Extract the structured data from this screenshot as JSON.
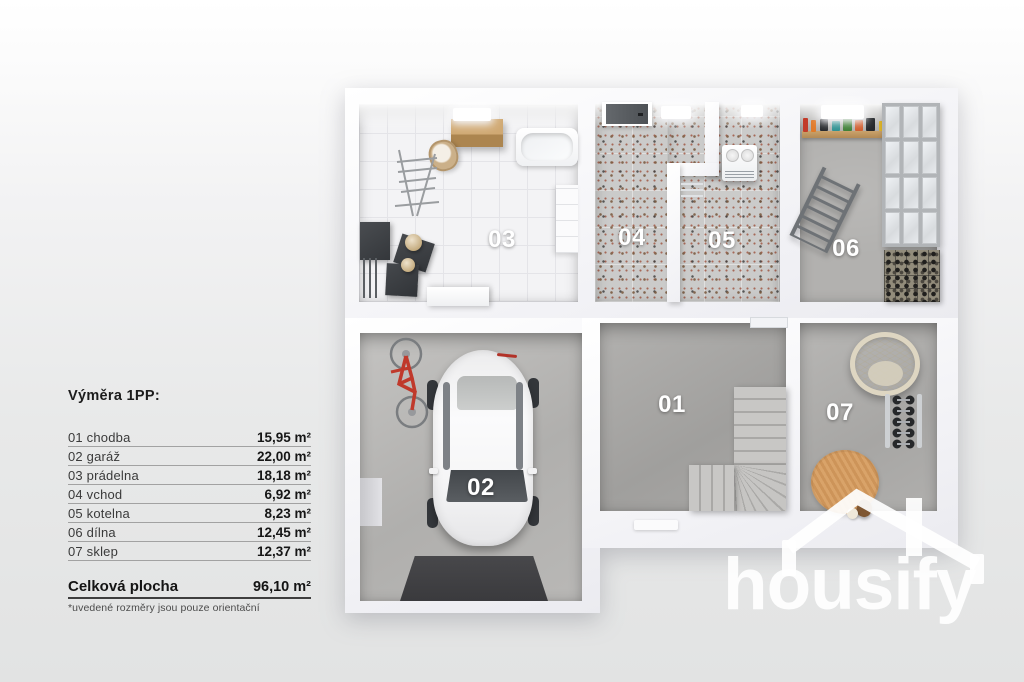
{
  "legend": {
    "title": "Výměra 1PP:",
    "rooms": [
      {
        "name": "01 chodba",
        "area": "15,95 m²"
      },
      {
        "name": "02 garáž",
        "area": "22,00 m²"
      },
      {
        "name": "03 prádelna",
        "area": "18,18 m²"
      },
      {
        "name": "04 vchod",
        "area": "6,92 m²"
      },
      {
        "name": "05 kotelna",
        "area": "8,23 m²"
      },
      {
        "name": "06 dílna",
        "area": "12,45 m²"
      },
      {
        "name": "07 sklep",
        "area": "12,37 m²"
      }
    ],
    "total_label": "Celková plocha",
    "total_area": "96,10 m²",
    "footnote": "*uvedené rozměry jsou pouze orientační"
  },
  "floorplan": {
    "labels": {
      "r01": "01",
      "r02": "02",
      "r03": "03",
      "r04": "04",
      "r05": "05",
      "r06": "06",
      "r07": "07"
    }
  },
  "logo": {
    "text": "housify"
  },
  "colors": {
    "wall": "#fbfbfd",
    "concrete": "#aeadab",
    "terrazzo": "#cbcbca",
    "tile": "#f3f3f5",
    "wood": "#c9a06a",
    "mat_dark": "#3d3d40",
    "label_white": "#ffffff",
    "logo_white": "#ffffff"
  }
}
